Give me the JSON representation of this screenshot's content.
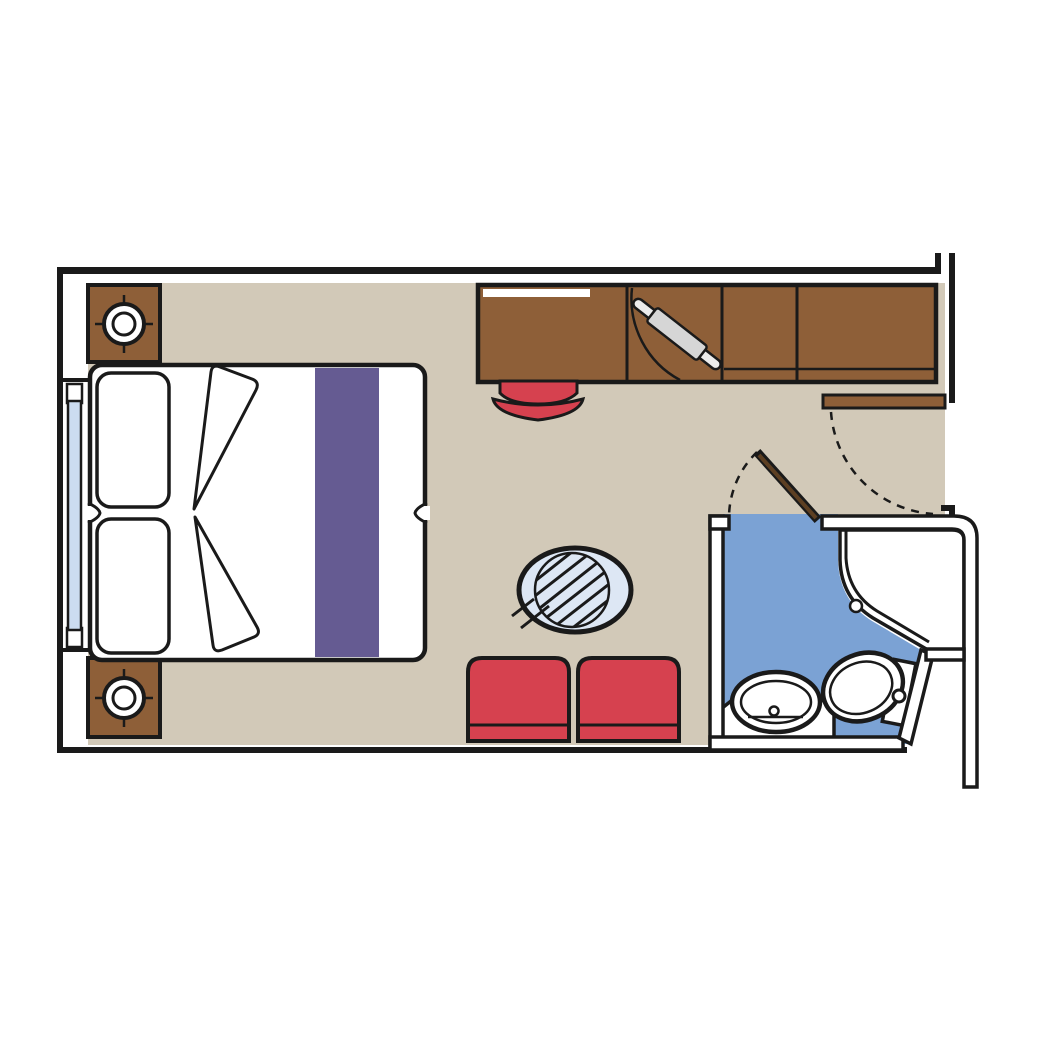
{
  "canvas": {
    "width": 1042,
    "height": 1042,
    "background": "#ffffff"
  },
  "colors": {
    "ink": "#1a1a1a",
    "floor": "#d2c9b8",
    "wood": "#8e5f38",
    "woodDark": "#5d3f22",
    "red": "#d6414f",
    "purple": "#655b92",
    "bath": "#7ba2d4",
    "tableGlass": "#dde7f4",
    "windowGlass": "#ccdcf0",
    "ironBoardLight": "#ececec",
    "ironBoardMid": "#d6d6d6"
  },
  "plan": {
    "type": "cabin-floor-plan",
    "rooms": [
      "cabin",
      "bathroom",
      "entrance-vestibule"
    ],
    "furniture": [
      "double-bed-with-runner",
      "pillow-left-upper",
      "pillow-left-lower",
      "nightstand-top-with-lamp",
      "nightstand-bottom-with-lamp",
      "desk-with-mirror",
      "closet-with-ironing-board",
      "wardrobe-two-sections",
      "desk-stool",
      "round-glass-table",
      "armchair-left",
      "armchair-right"
    ],
    "fixtures": [
      "picture-window",
      "entrance-door-with-swing",
      "bathroom-door-with-swing",
      "shower-with-drain",
      "washbasin-on-vanity",
      "toilet-with-cistern"
    ]
  }
}
